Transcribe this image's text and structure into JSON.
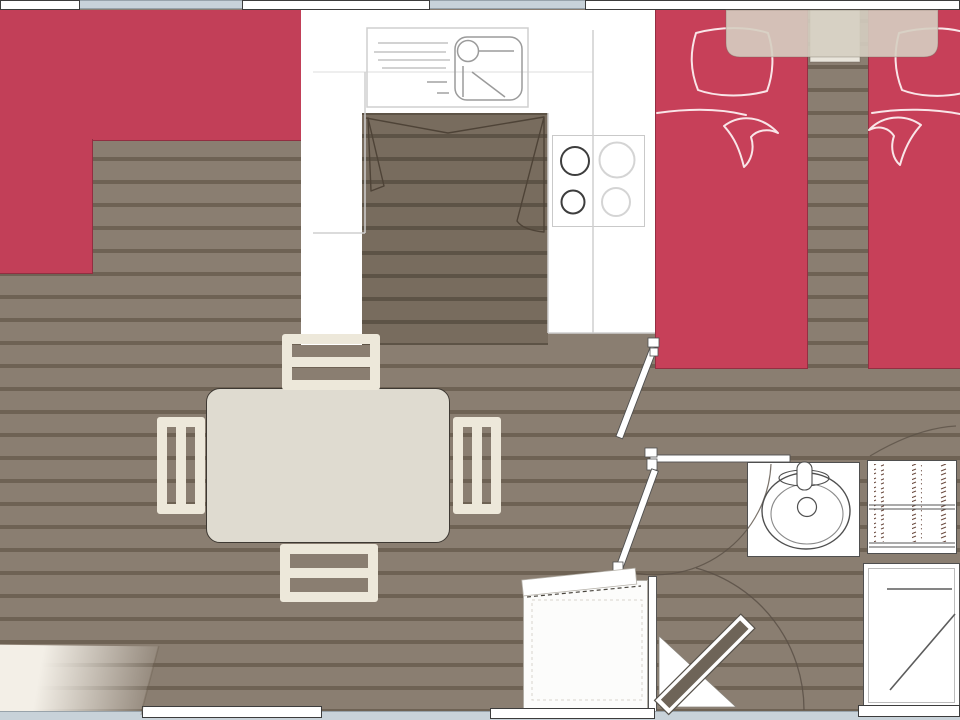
{
  "meta": {
    "type": "floorplan",
    "view": "top-down",
    "description": "mobile-home floor plan drawing, no text labels visible"
  },
  "palette": {
    "floor_plank": "#8a7e71",
    "floor_stripe": "#6e6254",
    "kitchen_floor_dark": "#786c5e",
    "accent_red": "#c23f58",
    "wall_white": "#ffffff",
    "window_blue": "#c8d2d9",
    "furniture_cream": "#ede8da",
    "table_beige": "#dfdbd0",
    "shelf_beige": "#d5cec2",
    "entrance_door_brown": "#6e6458",
    "linework_gray": "#4f4f4f",
    "counter_outline": "#c9c9c9"
  },
  "rooms": {
    "living": {
      "label": "living area"
    },
    "kitchen": {
      "label": "kitchen"
    },
    "bedroom": {
      "label": "twin bedroom"
    },
    "bathroom": {
      "label": "bathroom"
    }
  },
  "furniture": {
    "sofa": {
      "label": "corner sofa",
      "color": "#c23f58"
    },
    "dining_table": {
      "label": "dining table",
      "color": "#dfdbd0"
    },
    "chair": {
      "label": "dining chair",
      "color": "#ede8da"
    },
    "sink_counter": {
      "label": "kitchen sink and drainer"
    },
    "hob": {
      "label": "cooking hob, 4 burners"
    },
    "cupboard_doors": {
      "label": "kitchen cupboard door swings"
    },
    "bed": {
      "label": "single bed with pillow and folded duvet",
      "color": "#c23f58"
    },
    "overhead_shelf": {
      "label": "headboard shelf over beds"
    },
    "bedside_shelf": {
      "label": "bedside shelf between beds"
    },
    "washbasin": {
      "label": "bathroom washbasin"
    },
    "wardrobe": {
      "label": "wardrobe with shelves"
    },
    "shower": {
      "label": "shower cubicle"
    },
    "cabinet": {
      "label": "refrigerator / storage cabinet"
    },
    "entrance_door": {
      "label": "entrance door, open with swing arc"
    },
    "interior_door": {
      "label": "interior door leaf"
    },
    "window": {
      "label": "window"
    },
    "entrance_mat": {
      "label": "entrance light wedge"
    }
  },
  "counts": {
    "beds": 2,
    "chairs": 4,
    "hob_burners": 4,
    "top_windows": 2,
    "interior_doors": 2
  }
}
